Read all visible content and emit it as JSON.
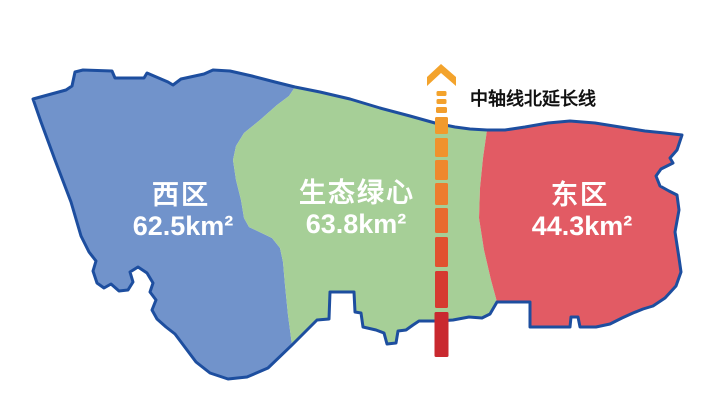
{
  "map": {
    "outline_color": "#1D4E9F",
    "label_color": "#FFFFFF",
    "background_color": "#FFFFFF",
    "regions": [
      {
        "id": "west",
        "name": "西区",
        "area": "62.5km²",
        "area_km2": 62.5,
        "color": "#7193CB"
      },
      {
        "id": "green-heart",
        "name": "生态绿心",
        "area": "63.8km²",
        "area_km2": 63.8,
        "color": "#A6CF97"
      },
      {
        "id": "east",
        "name": "东区",
        "area": "44.3km²",
        "area_km2": 44.3,
        "color": "#E25B64"
      }
    ]
  },
  "axis_line": {
    "label": "中轴线北延长线",
    "label_color": "#111111",
    "arrow_color": "#F3A32C",
    "x_center": 441.5,
    "dashes": [
      {
        "y": 91,
        "h": 5,
        "w": 10,
        "color": "#F3A32C"
      },
      {
        "y": 99,
        "h": 5,
        "w": 10,
        "color": "#F3A12C"
      },
      {
        "y": 107,
        "h": 6,
        "w": 11,
        "color": "#F29E2D"
      },
      {
        "y": 117,
        "h": 17,
        "w": 13,
        "color": "#F19A2D"
      },
      {
        "y": 138,
        "h": 19,
        "w": 13,
        "color": "#F0922D"
      },
      {
        "y": 160,
        "h": 20,
        "w": 13,
        "color": "#EF882D"
      },
      {
        "y": 183,
        "h": 22,
        "w": 13,
        "color": "#ED7C2E"
      },
      {
        "y": 208,
        "h": 25,
        "w": 13,
        "color": "#E96A2E"
      },
      {
        "y": 237,
        "h": 30,
        "w": 13,
        "color": "#E1512F"
      },
      {
        "y": 271,
        "h": 37,
        "w": 13,
        "color": "#D63A30"
      },
      {
        "y": 312,
        "h": 45,
        "w": 14,
        "color": "#C9292F"
      }
    ]
  }
}
